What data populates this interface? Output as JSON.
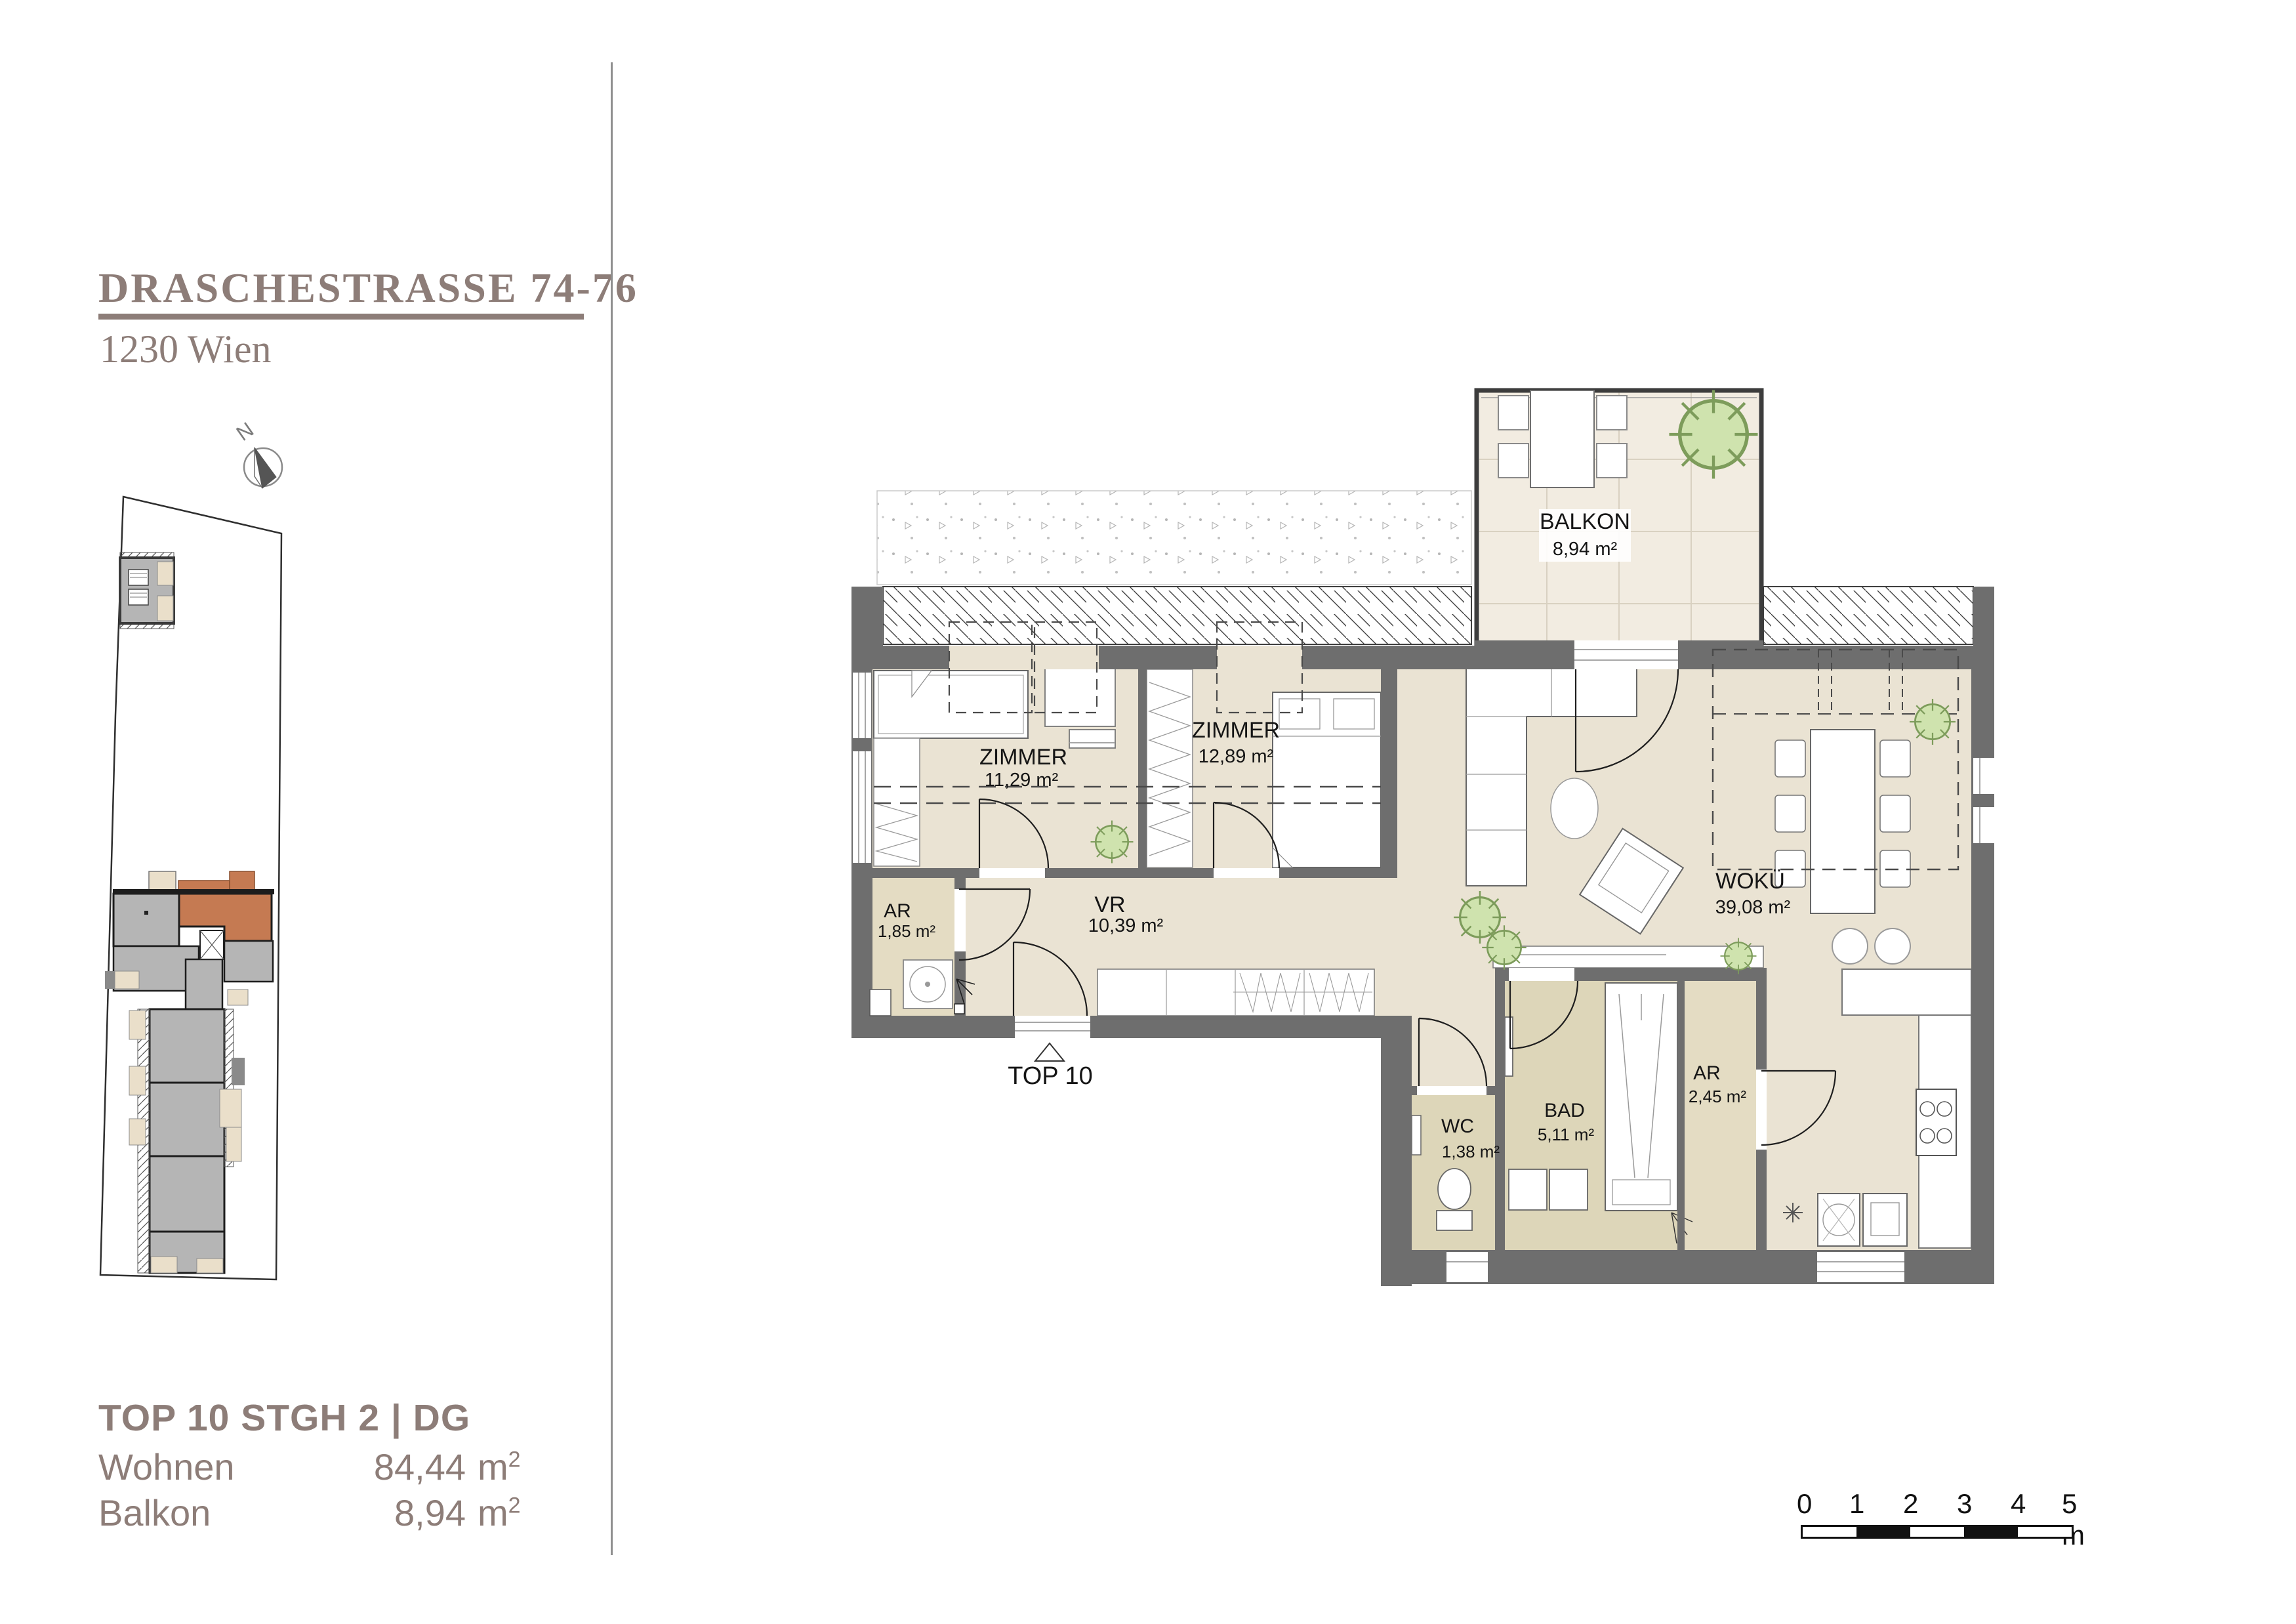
{
  "header": {
    "title": "DRASCHESTRASSE 74-76",
    "subtitle": "1230 Wien"
  },
  "compass": {
    "label": "N"
  },
  "legend": {
    "title": "TOP 10 STGH 2 | DG",
    "rows": [
      {
        "label": "Wohnen",
        "value": "84,44",
        "unit": "m",
        "sup": "2"
      },
      {
        "label": "Balkon",
        "value": "8,94",
        "unit": "m",
        "sup": "2"
      }
    ]
  },
  "plan": {
    "entrance": "TOP 10",
    "rooms": {
      "balkon": {
        "name": "BALKON",
        "area": "8,94 m²"
      },
      "zimmer1": {
        "name": "ZIMMER",
        "area": "11,29 m²"
      },
      "zimmer2": {
        "name": "ZIMMER",
        "area": "12,89 m²"
      },
      "woku": {
        "name": "WOKÜ",
        "area": "39,08 m²"
      },
      "vr": {
        "name": "VR",
        "area": "10,39 m²"
      },
      "ar1": {
        "name": "AR",
        "area": "1,85 m²"
      },
      "ar2": {
        "name": "AR",
        "area": "2,45 m²"
      },
      "wc": {
        "name": "WC",
        "area": "1,38 m²"
      },
      "bad": {
        "name": "BAD",
        "area": "5,11 m²"
      }
    }
  },
  "scale_bar": {
    "ticks": [
      "0",
      "1",
      "2",
      "3",
      "4"
    ],
    "last": "5 m"
  },
  "colors": {
    "accent": "#8d7d78",
    "wall": "#6e6e6e",
    "floor": "#eae3d3",
    "floor_dark": "#ddd6b9",
    "balcony_floor": "#f2ece1",
    "highlight_unit": "#c57a52",
    "site_building": "#b5b5b5",
    "plant": "#cfe3ae"
  }
}
